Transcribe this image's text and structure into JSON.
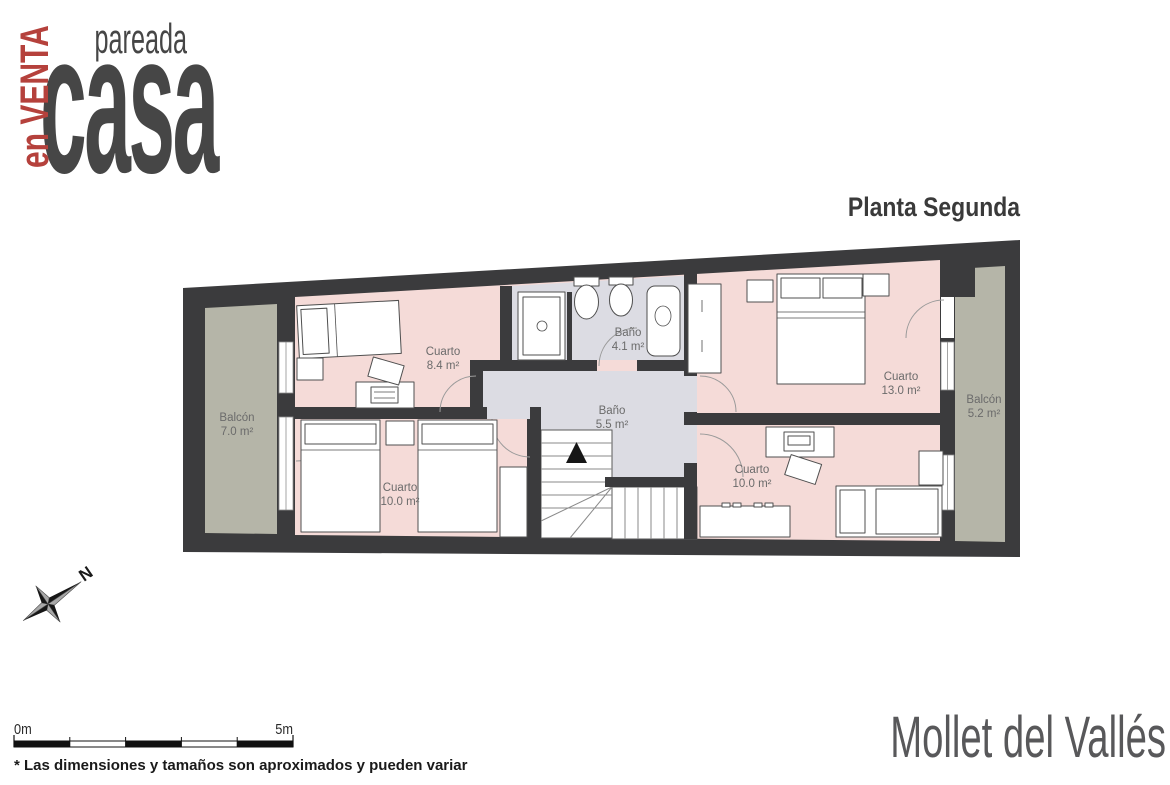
{
  "logo": {
    "brand": "casa",
    "product": "pareada",
    "status": "en VENTA"
  },
  "header": {
    "floor_title": "Planta Segunda"
  },
  "rooms": [
    {
      "name": "Cuarto",
      "area": "8.4 m²"
    },
    {
      "name": "Baño",
      "area": "4.1 m²"
    },
    {
      "name": "Baño",
      "area": "5.5 m²"
    },
    {
      "name": "Cuarto",
      "area": "13.0 m²"
    },
    {
      "name": "Balcón",
      "area": "7.0 m²"
    },
    {
      "name": "Balcón",
      "area": "5.2 m²"
    },
    {
      "name": "Cuarto",
      "area": "10.0 m²"
    },
    {
      "name": "Cuarto",
      "area": "10.0 m²"
    }
  ],
  "compass": {
    "north_label": "N"
  },
  "scale_bar": {
    "start_label": "0m",
    "end_label": "5m"
  },
  "footer": {
    "disclaimer": "* Las dimensiones y tamaños son aproximados y pueden variar",
    "location": "Mollet del Vallés"
  },
  "colors": {
    "wall": "#3b3b3d",
    "room": "#f5dbd8",
    "wet": "#dcdce3",
    "balcony": "#b5b5a8",
    "furn": "#4f4f4f",
    "arc": "#9a9a9a",
    "label": "#6b6b6b",
    "text_dark": "#464646",
    "accent_red": "#b5413c",
    "location": "#58585a"
  }
}
